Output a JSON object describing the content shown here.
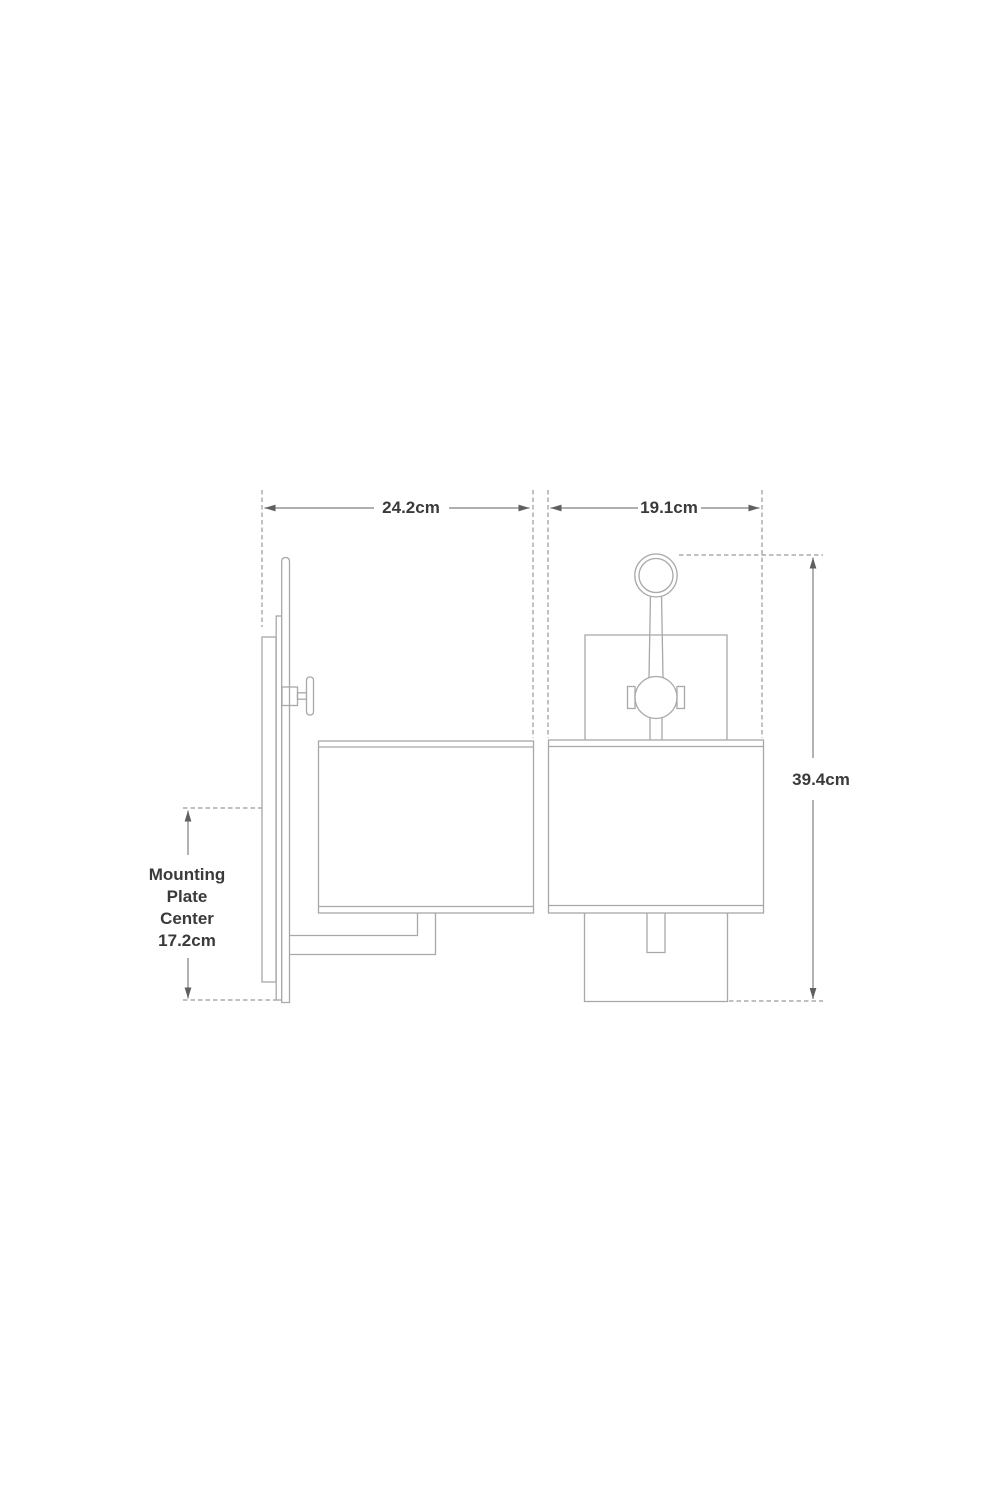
{
  "page": {
    "description": "Technical dimension drawing of a wall sconce light fixture, side view and front view",
    "background": "#ffffff"
  },
  "colors": {
    "drawing_line": "#a8a8a8",
    "dimension_line": "#7f7f7f",
    "dashed_line": "#9a9a9a",
    "arrow": "#5f5f5f",
    "text": "#3a3a3a"
  },
  "views": {
    "side": {
      "name": "Side view"
    },
    "front": {
      "name": "Front view"
    }
  },
  "dimensions": {
    "width_side": {
      "label": "24.2cm"
    },
    "width_front": {
      "label": "19.1cm"
    },
    "height": {
      "label": "39.4cm"
    },
    "mounting": {
      "label": "Mounting Plate Center 17.2cm",
      "label_lines": [
        "Mounting",
        "Plate",
        "Center",
        "17.2cm"
      ]
    }
  }
}
